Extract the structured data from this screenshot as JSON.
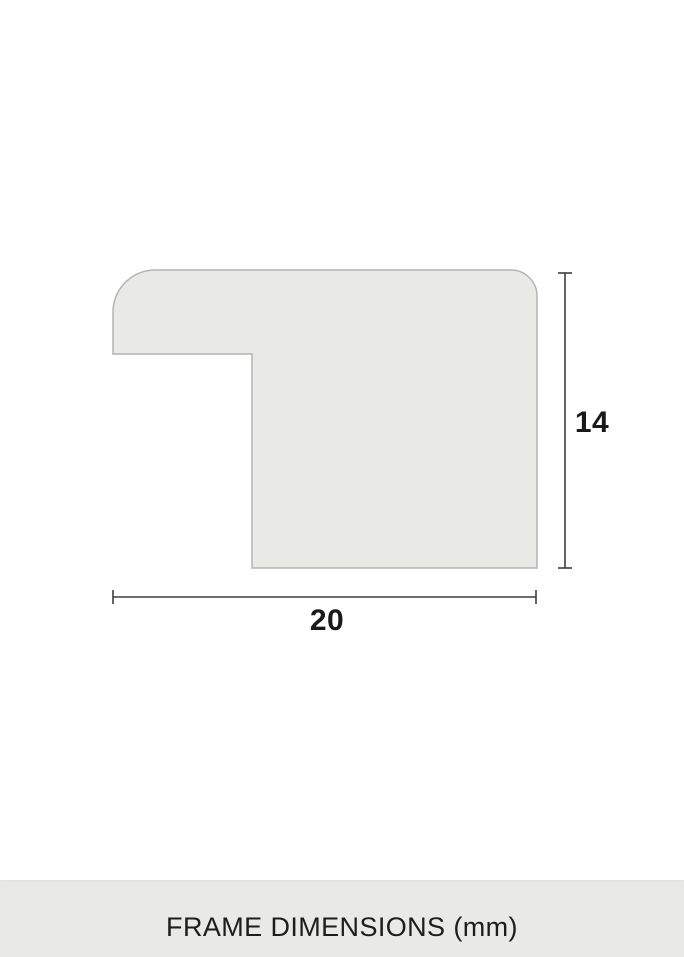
{
  "diagram": {
    "height_label": "14",
    "width_label": "20",
    "shape_fill": "#e9e9e6",
    "shape_stroke": "#b4b4b0",
    "dim_line_color": "#3d3d3d",
    "label_color": "#1a1a1a"
  },
  "footer": {
    "title": "FRAME DIMENSIONS (mm)",
    "background": "#e9e9e6",
    "text_color": "#1d1d1b"
  }
}
